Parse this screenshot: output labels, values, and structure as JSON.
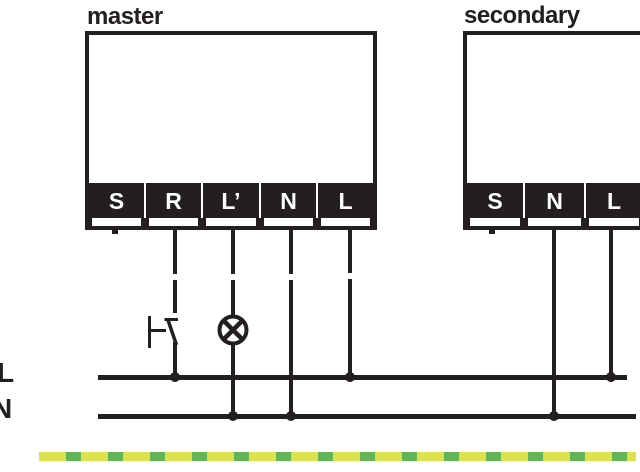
{
  "diagram": {
    "devices": [
      {
        "label": "master",
        "terminals": [
          "S",
          "R",
          "L’",
          "N",
          "L"
        ]
      },
      {
        "label": "secondary",
        "terminals": [
          "S",
          "N",
          "L"
        ]
      }
    ],
    "bus": {
      "line_label": "L",
      "neutral_label": "N"
    },
    "symbols": {
      "switch": "push-button-switch",
      "lamp": "lamp",
      "earth": "earth-conductor-green-yellow"
    },
    "colors": {
      "wire": "#231f20",
      "earth_yellow": "#dde24f",
      "earth_green": "#63b454"
    }
  }
}
